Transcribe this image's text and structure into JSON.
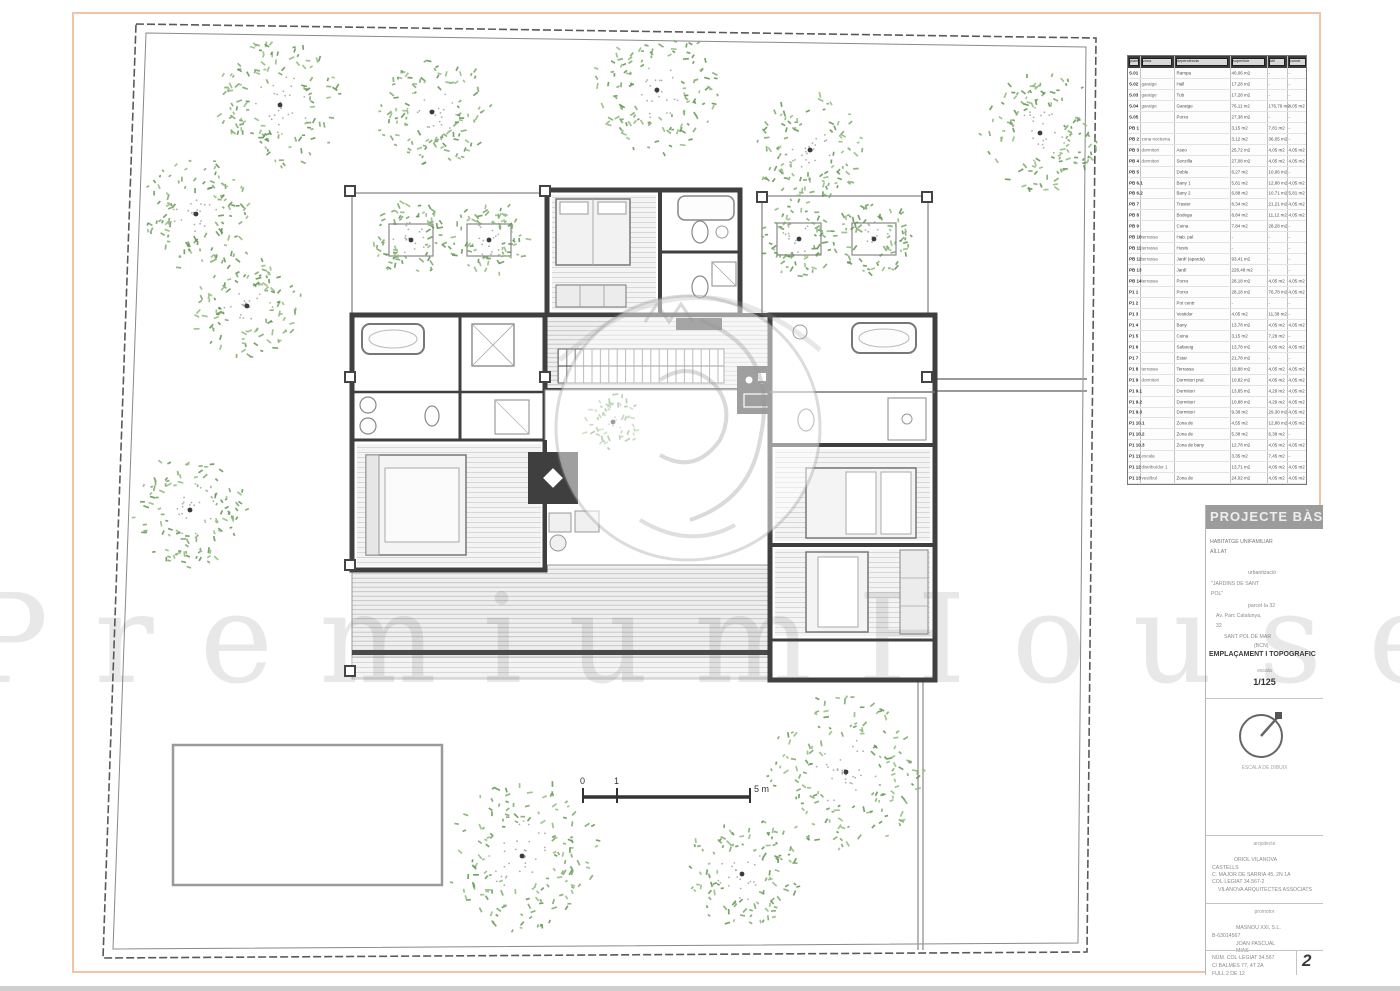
{
  "sheet": {
    "page_number": "2"
  },
  "watermark": {
    "text": "PremiumHouses"
  },
  "scale_bar": {
    "labels": [
      "0",
      "1",
      "5 m"
    ]
  },
  "colors": {
    "sheet_border": "#f2c3a6",
    "wall": "#3f3f3f",
    "boundary": "#5a5a5a",
    "table_header_bg": "#3c3c3c",
    "tree_greens": [
      "#7aa768",
      "#8fbc7d",
      "#619551"
    ]
  },
  "trees": [
    [
      280,
      105,
      62
    ],
    [
      432,
      112,
      55
    ],
    [
      657,
      90,
      60
    ],
    [
      810,
      150,
      52
    ],
    [
      1040,
      133,
      58
    ],
    [
      196,
      214,
      54
    ],
    [
      247,
      306,
      52
    ],
    [
      190,
      510,
      54
    ],
    [
      522,
      856,
      72
    ],
    [
      742,
      874,
      54
    ],
    [
      846,
      772,
      74
    ],
    [
      411,
      240,
      36
    ],
    [
      489,
      240,
      36
    ],
    [
      799,
      239,
      36
    ],
    [
      874,
      239,
      36
    ],
    [
      613,
      422,
      26
    ]
  ],
  "area_table": {
    "header_cells": [
      "planta",
      "zona",
      "dependència",
      "superfície",
      "útil",
      "constr."
    ],
    "rows": [
      {
        "c1": "S.01",
        "c2": "",
        "c3": "Rampa",
        "c4": "40,06 m2",
        "c5": "-",
        "c6": "-"
      },
      {
        "c1": "S.02",
        "c2": "garatge",
        "c3": "Hall",
        "c4": "17,28 m2",
        "c5": "-",
        "c6": "-"
      },
      {
        "c1": "S.03",
        "c2": "garatge",
        "c3": "Tub",
        "c4": "17,28 m2",
        "c5": "-",
        "c6": "-"
      },
      {
        "c1": "S.04",
        "c2": "garatge",
        "c3": "Garatge",
        "c4": "76,11 m2",
        "c5": "176,76 m2",
        "c6": "4,05 m2"
      },
      {
        "c1": "S.05",
        "c2": "",
        "c3": "Porxo",
        "c4": "27,38 m2",
        "c5": "-",
        "c6": "-"
      },
      {
        "c1": "PB 1",
        "c2": "",
        "c3": "",
        "c4": "3,15 m2",
        "c5": "7,81 m2",
        "c6": "-"
      },
      {
        "c1": "PB 2",
        "c2": "zona nocturna",
        "c3": "",
        "c4": "3,12 m2",
        "c5": "36,05 m2",
        "c6": "-"
      },
      {
        "c1": "PB 3",
        "c2": "dormitori",
        "c3": "Aseo",
        "c4": "25,72 m2",
        "c5": "4,05 m2",
        "c6": "4,05 m2"
      },
      {
        "c1": "PB 4",
        "c2": "dormitori",
        "c3": "Senzilla",
        "c4": "27,08 m2",
        "c5": "4,05 m2",
        "c6": "4,05 m2"
      },
      {
        "c1": "PB 5",
        "c2": "",
        "c3": "Doble",
        "c4": "6,27 m2",
        "c5": "10,06 m2",
        "c6": "-"
      },
      {
        "c1": "PB 6.1",
        "c2": "",
        "c3": "Bany 1",
        "c4": "5,81 m2",
        "c5": "12,88 m2",
        "c6": "4,05 m2"
      },
      {
        "c1": "PB 6.2",
        "c2": "",
        "c3": "Bany 2",
        "c4": "6,88 m2",
        "c5": "10,71 m2",
        "c6": "5,81 m2"
      },
      {
        "c1": "PB 7",
        "c2": "",
        "c3": "Traster",
        "c4": "8,34 m2",
        "c5": "21,21 m2",
        "c6": "4,05 m2"
      },
      {
        "c1": "PB 8",
        "c2": "",
        "c3": "Bodega",
        "c4": "8,84 m2",
        "c5": "11,12 m2",
        "c6": "4,05 m2"
      },
      {
        "c1": "PB 9",
        "c2": "",
        "c3": "Cuina",
        "c4": "7,84 m2",
        "c5": "28,28 m2",
        "c6": "-"
      },
      {
        "c1": "PB 10",
        "c2": "terrassa",
        "c3": "Hab. pal",
        "c4": "-",
        "c5": "-",
        "c6": "-"
      },
      {
        "c1": "PB 11",
        "c2": "terrassa",
        "c3": "Hosts",
        "c4": "-",
        "c5": "-",
        "c6": "-"
      },
      {
        "c1": "PB 12",
        "c2": "terrassa",
        "c3": "Jardí (aparda)",
        "c4": "93,41 m2",
        "c5": "-",
        "c6": "-"
      },
      {
        "c1": "PB 13",
        "c2": "",
        "c3": "Jardí",
        "c4": "228,48 m2",
        "c5": "-",
        "c6": "-"
      },
      {
        "c1": "PB 14",
        "c2": "terrassa",
        "c3": "Porxo",
        "c4": "28,18 m2",
        "c5": "4,05 m2",
        "c6": "4,05 m2"
      },
      {
        "c1": "P1 1",
        "c2": "",
        "c3": "Porxo",
        "c4": "28,18 m2",
        "c5": "76,78 m2",
        "c6": "4,05 m2"
      },
      {
        "c1": "P1 2",
        "c2": "",
        "c3": "Pot centr",
        "c4": "-",
        "c5": "-",
        "c6": "-"
      },
      {
        "c1": "P1 3",
        "c2": "",
        "c3": "Vestidor",
        "c4": "4,05 m2",
        "c5": "11,38 m2",
        "c6": "-"
      },
      {
        "c1": "P1 4",
        "c2": "",
        "c3": "Bany",
        "c4": "13,78 m2",
        "c5": "4,05 m2",
        "c6": "4,05 m2"
      },
      {
        "c1": "P1 5",
        "c2": "",
        "c3": "Cuina",
        "c4": "3,15 m2",
        "c5": "7,28 m2",
        "c6": "-"
      },
      {
        "c1": "P1 6",
        "c2": "",
        "c3": "Safareig",
        "c4": "13,78 m2",
        "c5": "4,05 m2",
        "c6": "4,05 m2"
      },
      {
        "c1": "P1 7",
        "c2": "",
        "c3": "Estar",
        "c4": "21,78 m2",
        "c5": "-",
        "c6": "-"
      },
      {
        "c1": "P1 8",
        "c2": "terrassa",
        "c3": "Terrassa",
        "c4": "19,88 m2",
        "c5": "4,05 m2",
        "c6": "4,05 m2"
      },
      {
        "c1": "P1 9",
        "c2": "dormitori",
        "c3": "Dormitori pral.",
        "c4": "10,82 m2",
        "c5": "4,05 m2",
        "c6": "4,05 m2"
      },
      {
        "c1": "P1 9.1",
        "c2": "",
        "c3": "Dormitori",
        "c4": "13,85 m2",
        "c5": "4,29 m2",
        "c6": "4,05 m2"
      },
      {
        "c1": "P1 9.2",
        "c2": "",
        "c3": "Dormitori",
        "c4": "10,88 m2",
        "c5": "4,29 m2",
        "c6": "4,05 m2"
      },
      {
        "c1": "P1 9.3",
        "c2": "",
        "c3": "Dormitori",
        "c4": "9,38 m2",
        "c5": "29,30 m2",
        "c6": "4,05 m2"
      },
      {
        "c1": "P1 10.1",
        "c2": "",
        "c3": "Zona de",
        "c4": "4,55 m2",
        "c5": "12,88 m2",
        "c6": "4,05 m2"
      },
      {
        "c1": "P1 10.2",
        "c2": "",
        "c3": "Zona de",
        "c4": "5,38 m2",
        "c5": "6,38 m2",
        "c6": "-"
      },
      {
        "c1": "P1 10.3",
        "c2": "",
        "c3": "Zona de bany",
        "c4": "12,78 m2",
        "c5": "4,05 m2",
        "c6": "4,05 m2"
      },
      {
        "c1": "P1 11",
        "c2": "escala",
        "c3": "",
        "c4": "3,35 m2",
        "c5": "7,45 m2",
        "c6": "-"
      },
      {
        "c1": "P1 12",
        "c2": "distribuïdor 1",
        "c3": "",
        "c4": "13,71 m2",
        "c5": "4,05 m2",
        "c6": "4,05 m2"
      },
      {
        "c1": "P1 13",
        "c2": "vestíbul",
        "c3": "Zona de",
        "c4": "24,02 m2",
        "c5": "4,05 m2",
        "c6": "4,05 m2"
      }
    ]
  },
  "title_block": {
    "header": "PROJECTE BÀSIC",
    "owner_lines": [
      "HABITATGE UNIFAMILIAR",
      "AÏLLAT"
    ],
    "location_lines": [
      "urbanització",
      "\"JARDINS DE SANT",
      "POL\"",
      "parcel·la 32",
      "Av. Parc Catalunya,",
      "32",
      "SANT POL DE MAR",
      "(BCN)"
    ],
    "drawing_title": "EMPLAÇAMENT I TOPOGRAFIC",
    "scale_label": "escala",
    "scale_value": "1/125",
    "north_caption": "ESCALA DE DIBUIX",
    "architect_label": "arquitecte",
    "architect_lines": [
      "ORIOL VILANOVA",
      "CASTELLS",
      "C. MAJOR DE SARRIA 45, 2N 1A",
      "COL·LEGIAT 34.567-2",
      "VILANOVA ARQUITECTES ASSOCIATS"
    ],
    "promoter_label": "promotor",
    "promoter_lines": [
      "MASNOU XXI, S.L.",
      "B-63014567",
      "JOAN PASCUAL",
      "MIAS"
    ],
    "footer_lines": [
      "NÚM. COL·LEGIAT 34.567",
      "C/ BALMES 77, 4T 2A",
      "FULL 2 DE 12"
    ],
    "page_number": "2"
  }
}
